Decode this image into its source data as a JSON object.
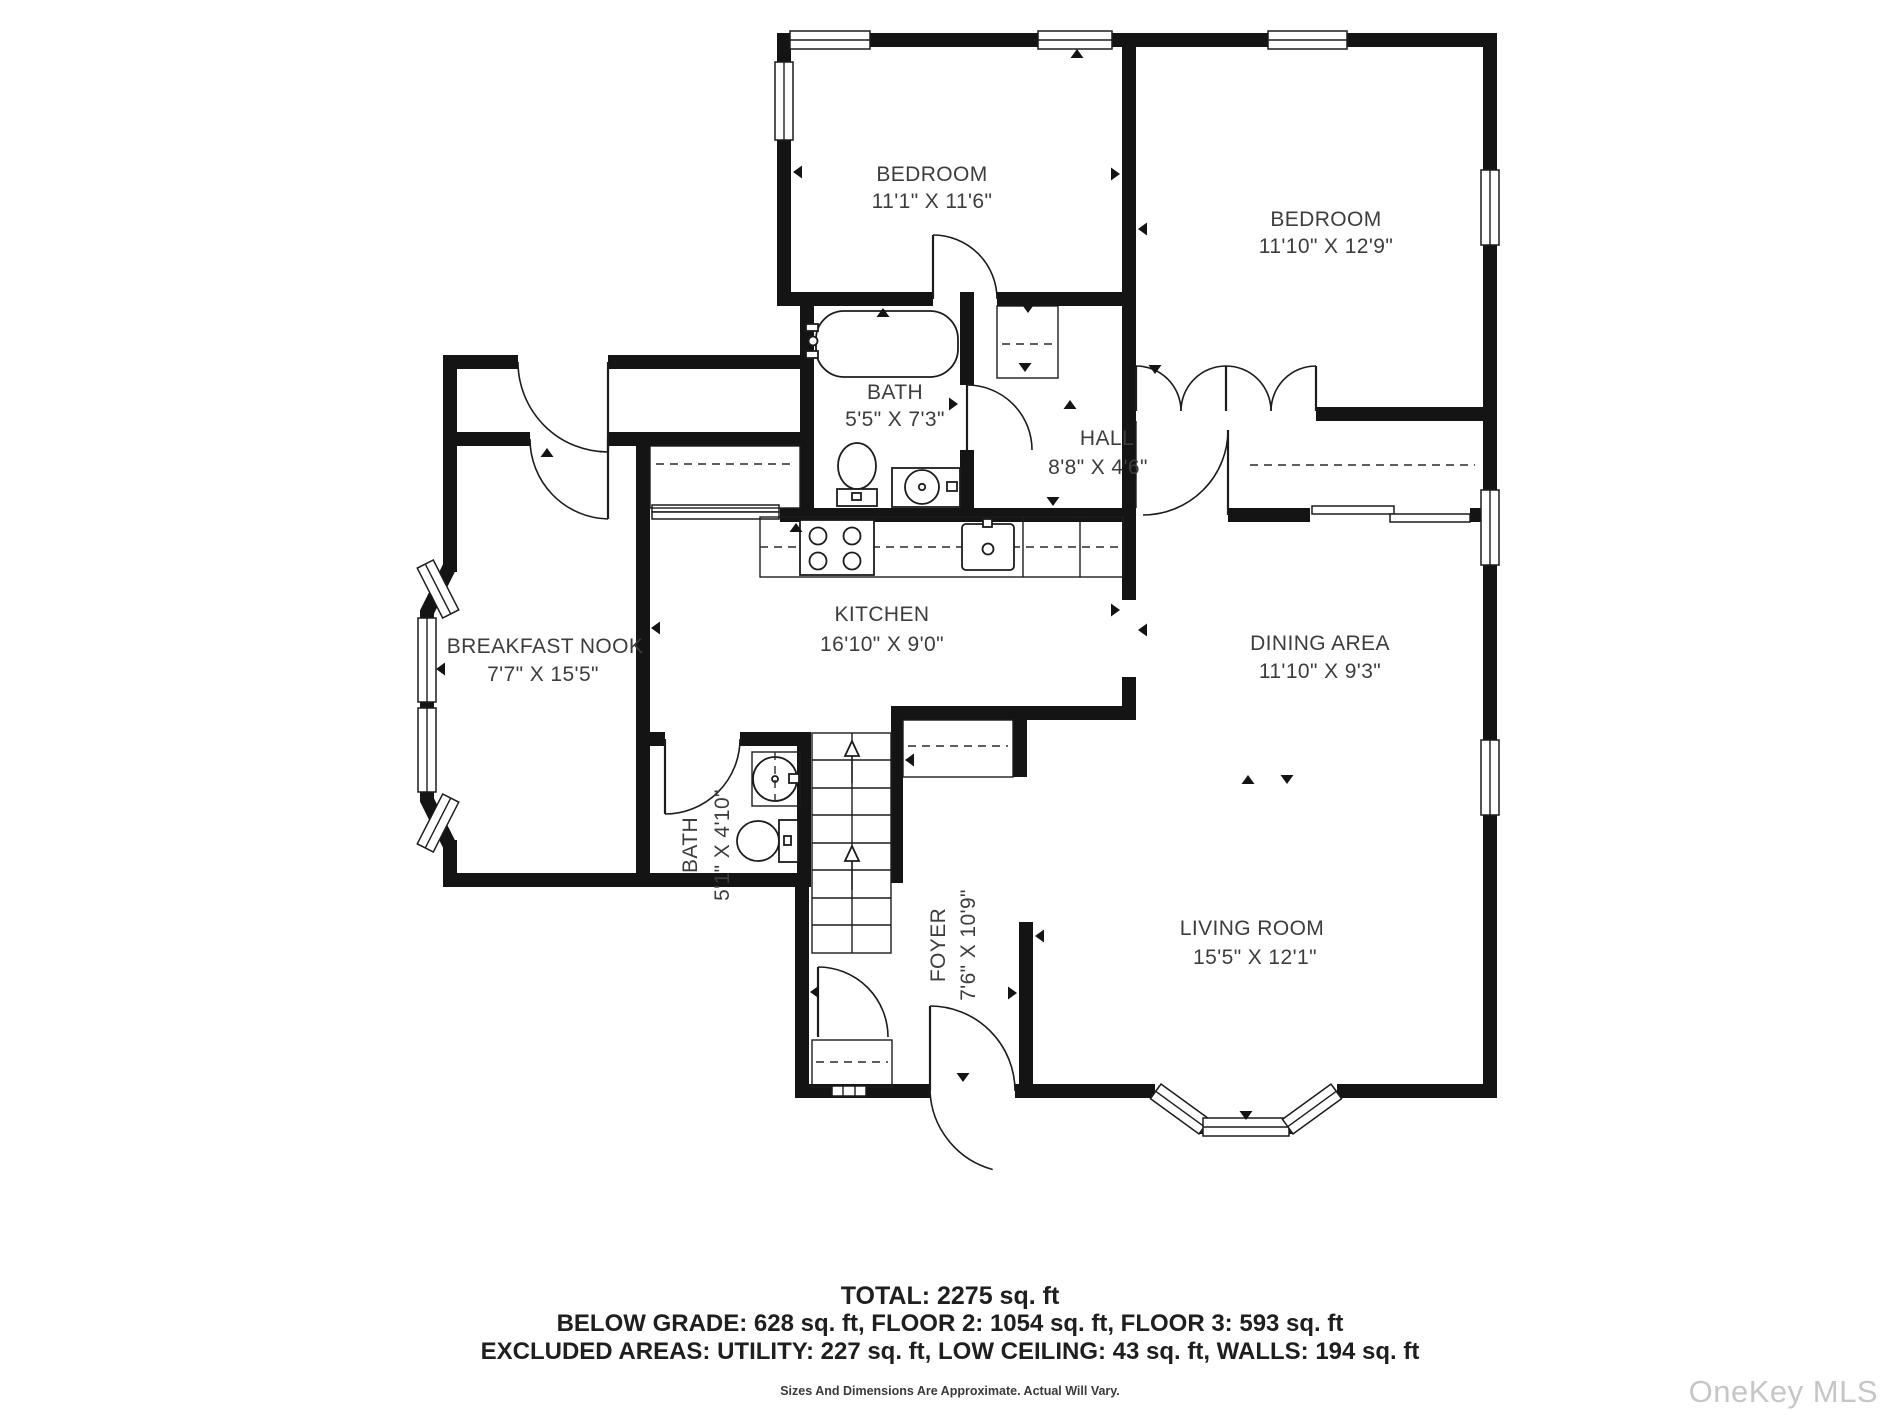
{
  "rooms": [
    {
      "name": "BEDROOM",
      "dims": "11'1\" X 11'6\""
    },
    {
      "name": "BEDROOM",
      "dims": "11'10\" X 12'9\""
    },
    {
      "name": "BATH",
      "dims": "5'5\" X 7'3\""
    },
    {
      "name": "HALL",
      "dims": "8'8\" X 4'6\""
    },
    {
      "name": "BREAKFAST NOOK",
      "dims": "7'7\" X 15'5\""
    },
    {
      "name": "KITCHEN",
      "dims": "16'10\" X 9'0\""
    },
    {
      "name": "DINING AREA",
      "dims": "11'10\" X 9'3\""
    },
    {
      "name": "BATH",
      "dims": "5'1\" X 4'10\""
    },
    {
      "name": "FOYER",
      "dims": "7'6\" X 10'9\""
    },
    {
      "name": "LIVING ROOM",
      "dims": "15'5\" X 12'1\""
    }
  ],
  "footer": {
    "total": "TOTAL: 2275 sq. ft",
    "line2": "BELOW GRADE: 628 sq. ft, FLOOR 2: 1054 sq. ft, FLOOR 3: 593 sq. ft",
    "line3": "EXCLUDED AREAS: UTILITY: 227 sq. ft, LOW CEILING: 43 sq. ft, WALLS: 194 sq. ft",
    "disclaimer": "Sizes And Dimensions Are Approximate. Actual Will Vary."
  },
  "watermark": "OneKey MLS",
  "colors": {
    "wall": "#141414",
    "label": "#3d3d3d",
    "watermark": "#c6c6c6"
  }
}
